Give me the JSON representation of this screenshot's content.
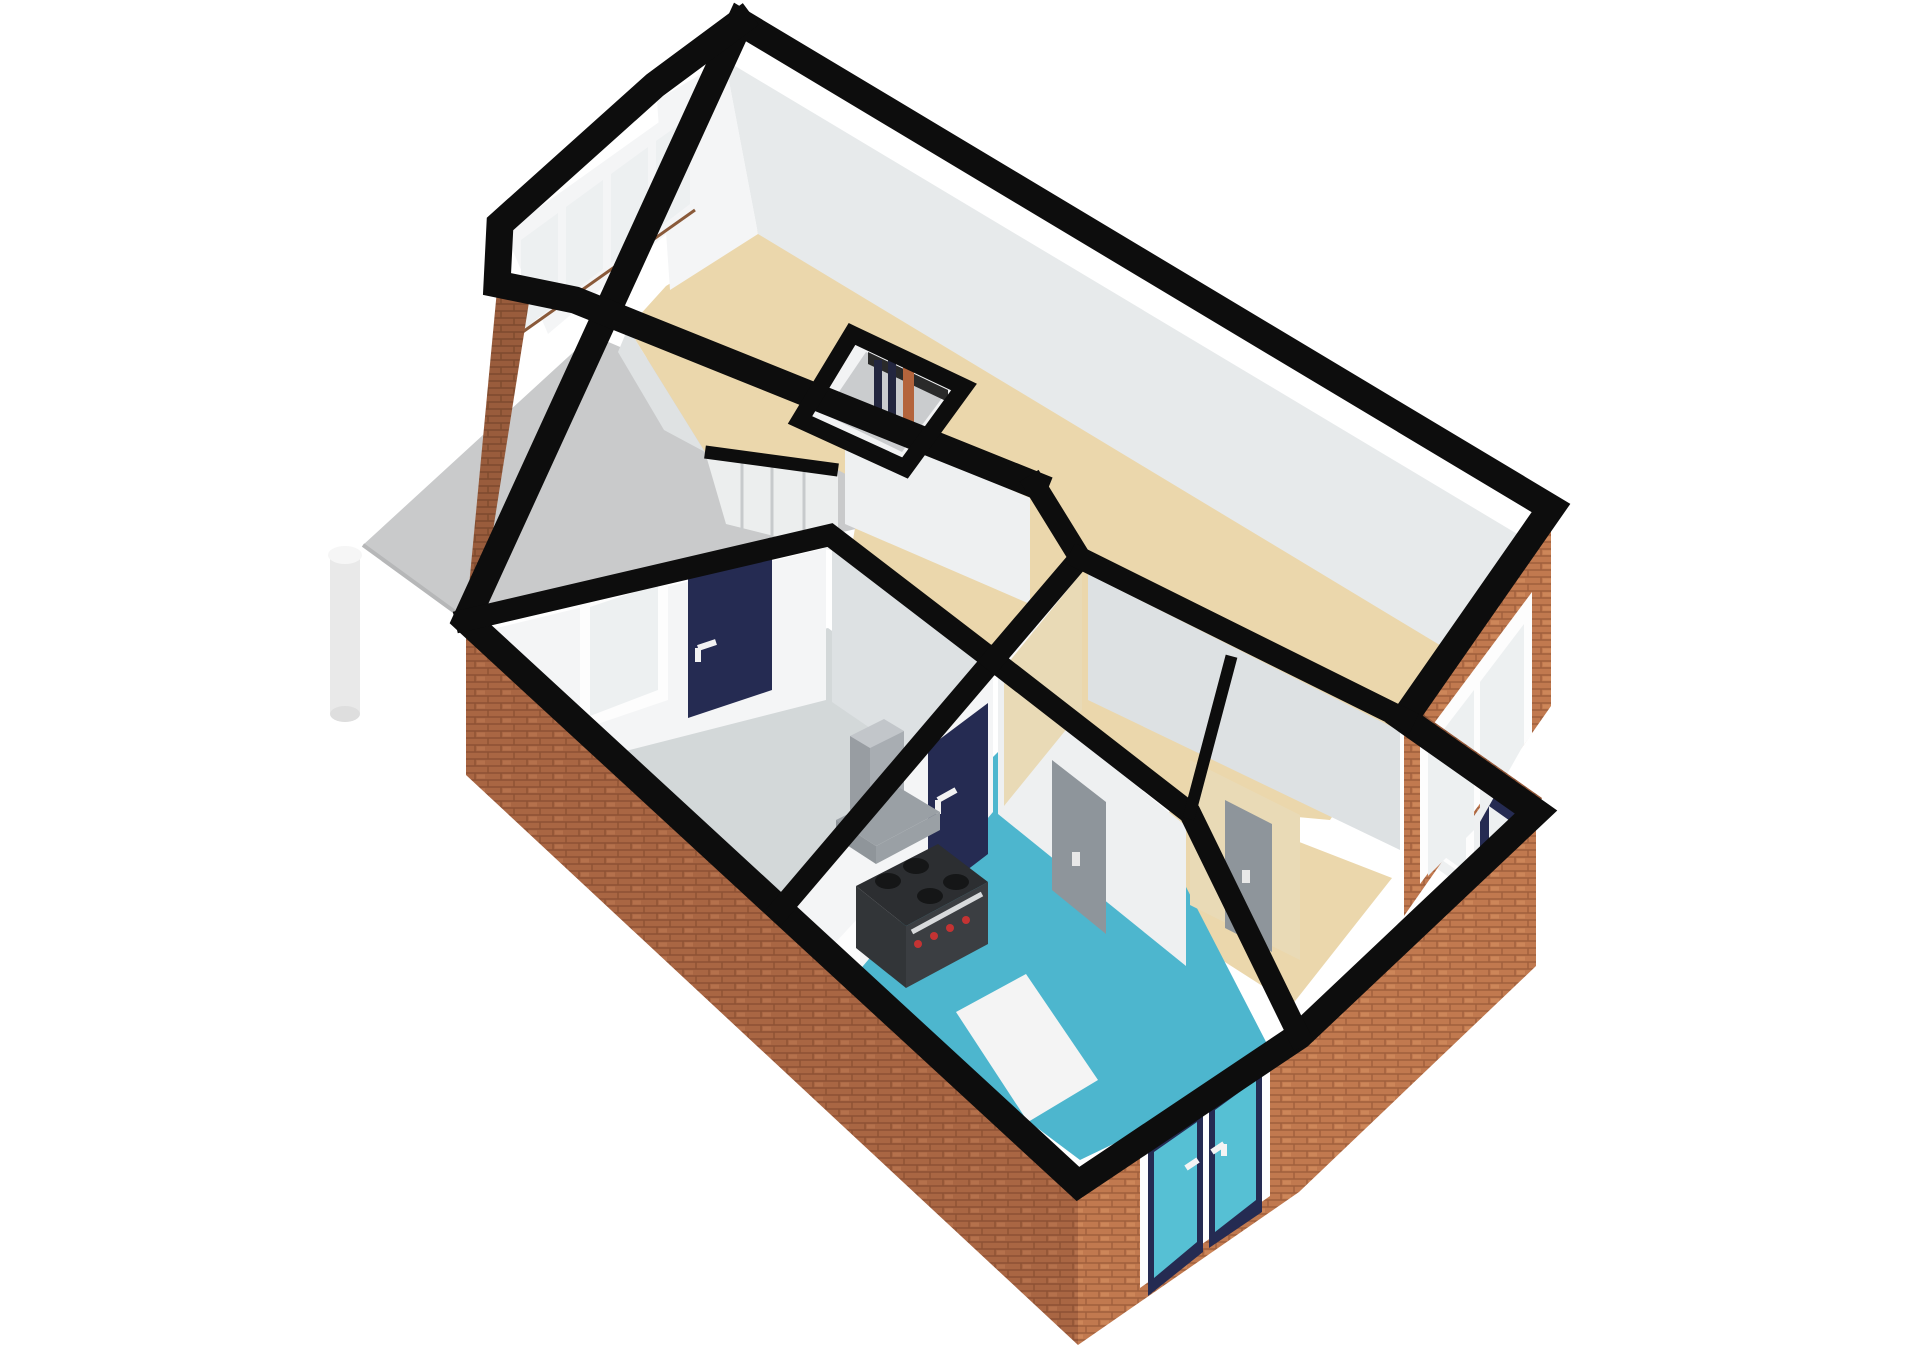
{
  "scene": {
    "kind": "3d-floorplan-cutaway-render",
    "view": "isometric top-down dollhouse view",
    "background": "#ffffff",
    "no_visible_text": true
  },
  "palette": {
    "cut_wall_black": "#0d0d0d",
    "wall_white": "#f4f5f6",
    "wall_gray": "#e7eaeb",
    "wall_beige": "#e9dab6",
    "floor_beige": "#ebd7ac",
    "floor_gray": "#d3d8d9",
    "floor_teal": "#4db6ce",
    "mat_white": "#f4f4f4",
    "deck_gray": "#c9cacb",
    "column_white": "#f0f0f0",
    "brick_sw": "#a96643",
    "brick_se": "#c1794f",
    "brick_nw": "#995c3c",
    "door_navy": "#252b52",
    "door_gray": "#8e959b",
    "door_closet_white": "#fafafa",
    "glass_pale": "#edf0f1",
    "glass_teal": "#56c0d4",
    "frame_white": "#fdfdfd",
    "sill_brown": "#8a5a3a",
    "pipe_copper": "#b4643c",
    "pipe_dark": "#23263f",
    "stove_top_dark": "#2c2e31",
    "stove_front": "#3b3e42",
    "burner_dark": "#151617",
    "knob_red": "#c43333",
    "hood_gray": "#9aa0a5",
    "stair_shadow": "#9fa3a5"
  },
  "rooms": [
    {
      "id": "living_room",
      "label": "living room with bay window",
      "floor_color": "#ebd7ac"
    },
    {
      "id": "hallway",
      "label": "hallway with stairs and closets",
      "floor_color": "#ebd7ac"
    },
    {
      "id": "small_room",
      "label": "small room off entry",
      "floor_color": "#ebd7ac"
    },
    {
      "id": "entry_hall",
      "label": "entry hall with front door",
      "floor_color": "#ebd7ac"
    },
    {
      "id": "bedroom",
      "label": "bedroom opening onto balcony",
      "floor_color": "#d3d8d9"
    },
    {
      "id": "kitchen",
      "label": "kitchen with range and hood",
      "floor_color": "#4db6ce"
    },
    {
      "id": "balcony",
      "label": "balcony deck on round column",
      "floor_color": "#c9cacb"
    }
  ],
  "features": {
    "bay_windows": 4,
    "bedroom_balcony_door": "navy with white handle",
    "bedroom_balcony_window": 1,
    "kitchen_door": "navy",
    "interior_sliding_doors_gray": 2,
    "closet_doors_white": 2,
    "utility_shaft_pipes": [
      "dark",
      "dark",
      "copper"
    ],
    "living_sliding_window_se": 1,
    "entry_window": 1,
    "front_door": "navy with glass pane",
    "kitchen_french_doors": "navy frames, teal glass, white handles",
    "stove": "range with 4 burners, red knobs, steel handle",
    "hood": "gray extractor with chimney"
  }
}
